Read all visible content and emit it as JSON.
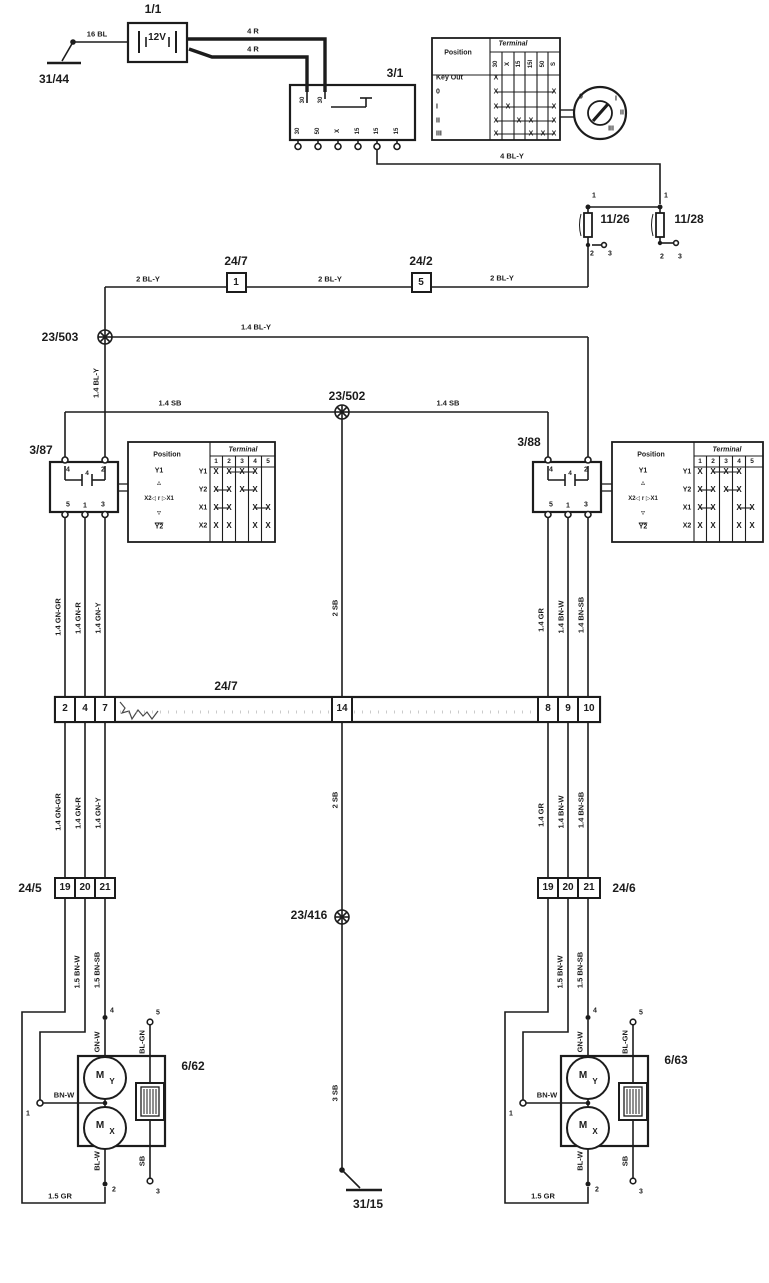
{
  "diagram": {
    "type": "wiring-diagram",
    "ink_color": "#1c1c1c",
    "bg_color": "#ffffff"
  },
  "ignition_table": {
    "position_header": "Position",
    "terminal_header": "Terminal",
    "columns": [
      "30",
      "X",
      "15",
      "15I",
      "50",
      "S"
    ],
    "rows": [
      {
        "label": "Key Out",
        "marks": [
          1,
          0,
          0,
          0,
          0,
          0
        ]
      },
      {
        "label": "0",
        "marks": [
          1,
          0,
          0,
          0,
          0,
          1
        ]
      },
      {
        "label": "I",
        "marks": [
          1,
          1,
          0,
          0,
          0,
          1
        ]
      },
      {
        "label": "II",
        "marks": [
          1,
          0,
          1,
          1,
          0,
          1
        ]
      },
      {
        "label": "III",
        "marks": [
          1,
          0,
          0,
          1,
          1,
          1
        ]
      }
    ]
  },
  "relay_table": {
    "position_header": "Position",
    "terminal_header": "Terminal",
    "columns": [
      "1",
      "2",
      "3",
      "4",
      "5"
    ],
    "rows": [
      {
        "label": "Y1",
        "marks": [
          1,
          1,
          1,
          1,
          0
        ]
      },
      {
        "label": "Y2",
        "marks": [
          1,
          1,
          1,
          1,
          0
        ]
      },
      {
        "label": "X1",
        "marks": [
          1,
          1,
          0,
          1,
          1
        ]
      },
      {
        "label": "X2",
        "marks": [
          1,
          1,
          0,
          1,
          1
        ]
      }
    ],
    "position_symbols": [
      "Y1",
      "▵",
      "X2◁ r ▷X1",
      "▿",
      "Y2"
    ]
  },
  "labels": [
    {
      "n": "ground-31-44-label",
      "t": "31/44",
      "x": 54,
      "y": 79,
      "fs": 12
    },
    {
      "n": "wire-label-16-bl",
      "t": "16 BL",
      "x": 97,
      "y": 34,
      "fs": 7.5
    },
    {
      "n": "battery-id",
      "t": "1/1",
      "x": 153,
      "y": 9,
      "fs": 12
    },
    {
      "n": "battery-voltage",
      "t": "12V",
      "x": 157,
      "y": 38,
      "fs": 10
    },
    {
      "n": "wire-label-4-r-upper",
      "t": "4 R",
      "x": 253,
      "y": 31,
      "fs": 7.5
    },
    {
      "n": "wire-label-4-r-lower",
      "t": "4 R",
      "x": 253,
      "y": 49,
      "fs": 7.5
    },
    {
      "n": "ignition-switch-id",
      "t": "3/1",
      "x": 395,
      "y": 73,
      "fs": 12
    },
    {
      "n": "ignition-pin-top-1",
      "t": "30",
      "x": 303,
      "y": 100,
      "fs": 6,
      "r": 1
    },
    {
      "n": "ignition-pin-top-2",
      "t": "30",
      "x": 321,
      "y": 100,
      "fs": 6,
      "r": 1
    },
    {
      "n": "ignition-pin-1",
      "t": "30",
      "x": 298,
      "y": 131,
      "fs": 6,
      "r": 1
    },
    {
      "n": "ignition-pin-2",
      "t": "50",
      "x": 318,
      "y": 131,
      "fs": 6,
      "r": 1
    },
    {
      "n": "ignition-pin-3",
      "t": "X",
      "x": 338,
      "y": 131,
      "fs": 6,
      "r": 1
    },
    {
      "n": "ignition-pin-4",
      "t": "15",
      "x": 358,
      "y": 131,
      "fs": 6,
      "r": 1
    },
    {
      "n": "ignition-pin-5",
      "t": "15",
      "x": 377,
      "y": 131,
      "fs": 6,
      "r": 1
    },
    {
      "n": "ignition-pin-6",
      "t": "15",
      "x": 397,
      "y": 131,
      "fs": 6,
      "r": 1
    },
    {
      "n": "key-position-0",
      "t": "0",
      "x": 581,
      "y": 97,
      "fs": 7
    },
    {
      "n": "key-position-i",
      "t": "I",
      "x": 616,
      "y": 99,
      "fs": 7
    },
    {
      "n": "key-position-ii",
      "t": "II",
      "x": 622,
      "y": 113,
      "fs": 7
    },
    {
      "n": "key-position-iii",
      "t": "III",
      "x": 611,
      "y": 129,
      "fs": 7
    },
    {
      "n": "wire-label-4-bl-y",
      "t": "4 BL-Y",
      "x": 512,
      "y": 156,
      "fs": 7.5
    },
    {
      "n": "fuse-11-26-pin-1",
      "t": "1",
      "x": 594,
      "y": 196,
      "fs": 7
    },
    {
      "n": "fuse-11-28-pin-1",
      "t": "1",
      "x": 666,
      "y": 196,
      "fs": 7
    },
    {
      "n": "fuse-11-26-id",
      "t": "11/26",
      "x": 615,
      "y": 219,
      "fs": 12
    },
    {
      "n": "fuse-11-28-id",
      "t": "11/28",
      "x": 689,
      "y": 219,
      "fs": 12
    },
    {
      "n": "fuse-11-26-pin-2",
      "t": "2",
      "x": 592,
      "y": 254,
      "fs": 7
    },
    {
      "n": "fuse-11-26-pin-3",
      "t": "3",
      "x": 610,
      "y": 254,
      "fs": 7
    },
    {
      "n": "fuse-11-28-pin-2",
      "t": "2",
      "x": 662,
      "y": 257,
      "fs": 7
    },
    {
      "n": "fuse-11-28-pin-3",
      "t": "3",
      "x": 680,
      "y": 257,
      "fs": 7
    },
    {
      "n": "wire-label-2-bl-y-a",
      "t": "2 BL-Y",
      "x": 148,
      "y": 279,
      "fs": 7.5
    },
    {
      "n": "connector-24-7-inline-id",
      "t": "24/7",
      "x": 236,
      "y": 261,
      "fs": 12
    },
    {
      "n": "connector-24-7-inline-pin",
      "t": "1",
      "x": 236,
      "y": 283,
      "fs": 10
    },
    {
      "n": "wire-label-2-bl-y-b",
      "t": "2 BL-Y",
      "x": 330,
      "y": 279,
      "fs": 7.5
    },
    {
      "n": "connector-24-2-id",
      "t": "24/2",
      "x": 421,
      "y": 261,
      "fs": 12
    },
    {
      "n": "connector-24-2-pin",
      "t": "5",
      "x": 421,
      "y": 283,
      "fs": 10
    },
    {
      "n": "wire-label-2-bl-y-c",
      "t": "2 BL-Y",
      "x": 502,
      "y": 278,
      "fs": 7.5
    },
    {
      "n": "splice-23-503-id",
      "t": "23/503",
      "x": 60,
      "y": 337,
      "fs": 12
    },
    {
      "n": "wire-label-1-4-bl-y-h",
      "t": "1.4 BL-Y",
      "x": 256,
      "y": 327,
      "fs": 7.5
    },
    {
      "n": "wire-label-1-4-bl-y-v",
      "t": "1.4 BL-Y",
      "x": 96,
      "y": 383,
      "fs": 7.5,
      "r": 1
    },
    {
      "n": "splice-23-502-id",
      "t": "23/502",
      "x": 347,
      "y": 396,
      "fs": 12
    },
    {
      "n": "wire-label-1-4-sb-a",
      "t": "1.4 SB",
      "x": 170,
      "y": 403,
      "fs": 7.5
    },
    {
      "n": "wire-label-1-4-sb-b",
      "t": "1.4 SB",
      "x": 448,
      "y": 403,
      "fs": 7.5
    },
    {
      "n": "relay-3-87-id",
      "t": "3/87",
      "x": 41,
      "y": 450,
      "fs": 12
    },
    {
      "n": "relay-3-88-id",
      "t": "3/88",
      "x": 529,
      "y": 442,
      "fs": 12
    },
    {
      "n": "relay-3-87-pin-4",
      "t": "4",
      "x": 68,
      "y": 470,
      "fs": 7
    },
    {
      "n": "relay-3-87-pin-2",
      "t": "2",
      "x": 103,
      "y": 470,
      "fs": 7
    },
    {
      "n": "relay-3-87-coil-4",
      "t": "4",
      "x": 87,
      "y": 474,
      "fs": 6.5
    },
    {
      "n": "relay-3-87-pin-5",
      "t": "5",
      "x": 68,
      "y": 505,
      "fs": 7
    },
    {
      "n": "relay-3-87-pin-1",
      "t": "1",
      "x": 85,
      "y": 506,
      "fs": 7
    },
    {
      "n": "relay-3-87-pin-3",
      "t": "3",
      "x": 103,
      "y": 505,
      "fs": 7
    },
    {
      "n": "relay-3-88-pin-4",
      "t": "4",
      "x": 551,
      "y": 470,
      "fs": 7
    },
    {
      "n": "relay-3-88-pin-2",
      "t": "2",
      "x": 586,
      "y": 470,
      "fs": 7
    },
    {
      "n": "relay-3-88-coil-4",
      "t": "4",
      "x": 570,
      "y": 474,
      "fs": 6.5
    },
    {
      "n": "relay-3-88-pin-5",
      "t": "5",
      "x": 551,
      "y": 505,
      "fs": 7
    },
    {
      "n": "relay-3-88-pin-1",
      "t": "1",
      "x": 568,
      "y": 506,
      "fs": 7
    },
    {
      "n": "relay-3-88-pin-3",
      "t": "3",
      "x": 586,
      "y": 505,
      "fs": 7
    },
    {
      "n": "wire-label-1-4-gn-gr-upper",
      "t": "1.4 GN-GR",
      "x": 58,
      "y": 617,
      "fs": 7.5,
      "r": 1
    },
    {
      "n": "wire-label-1-4-gn-r-upper",
      "t": "1.4 GN-R",
      "x": 78,
      "y": 618,
      "fs": 7.5,
      "r": 1
    },
    {
      "n": "wire-label-1-4-gn-y-upper",
      "t": "1.4 GN-Y",
      "x": 98,
      "y": 618,
      "fs": 7.5,
      "r": 1
    },
    {
      "n": "wire-label-2-sb-upper",
      "t": "2 SB",
      "x": 335,
      "y": 608,
      "fs": 7.5,
      "r": 1
    },
    {
      "n": "wire-label-1-4-gr-upper",
      "t": "1.4 GR",
      "x": 541,
      "y": 620,
      "fs": 7.5,
      "r": 1
    },
    {
      "n": "wire-label-1-4-bn-w-upper",
      "t": "1.4 BN-W",
      "x": 561,
      "y": 617,
      "fs": 7.5,
      "r": 1
    },
    {
      "n": "wire-label-1-4-bn-sb-upper",
      "t": "1.4 BN-SB",
      "x": 581,
      "y": 615,
      "fs": 7.5,
      "r": 1
    },
    {
      "n": "connector-24-7-id",
      "t": "24/7",
      "x": 226,
      "y": 686,
      "fs": 12
    },
    {
      "n": "connector-24-7-pin-2",
      "t": "2",
      "x": 65,
      "y": 709,
      "fs": 10
    },
    {
      "n": "connector-24-7-pin-4",
      "t": "4",
      "x": 85,
      "y": 709,
      "fs": 10
    },
    {
      "n": "connector-24-7-pin-7",
      "t": "7",
      "x": 105,
      "y": 709,
      "fs": 10
    },
    {
      "n": "connector-24-7-pin-14",
      "t": "14",
      "x": 342,
      "y": 709,
      "fs": 10
    },
    {
      "n": "connector-24-7-pin-8",
      "t": "8",
      "x": 548,
      "y": 709,
      "fs": 10
    },
    {
      "n": "connector-24-7-pin-9",
      "t": "9",
      "x": 568,
      "y": 709,
      "fs": 10
    },
    {
      "n": "connector-24-7-pin-10",
      "t": "10",
      "x": 589,
      "y": 709,
      "fs": 10
    },
    {
      "n": "wire-label-1-4-gn-gr-lower",
      "t": "1.4 GN-GR",
      "x": 58,
      "y": 812,
      "fs": 7.5,
      "r": 1
    },
    {
      "n": "wire-label-1-4-gn-r-lower",
      "t": "1.4 GN-R",
      "x": 78,
      "y": 813,
      "fs": 7.5,
      "r": 1
    },
    {
      "n": "wire-label-1-4-gn-y-lower",
      "t": "1.4 GN-Y",
      "x": 98,
      "y": 813,
      "fs": 7.5,
      "r": 1
    },
    {
      "n": "wire-label-2-sb-lower",
      "t": "2 SB",
      "x": 335,
      "y": 800,
      "fs": 7.5,
      "r": 1
    },
    {
      "n": "wire-label-1-4-gr-lower",
      "t": "1.4 GR",
      "x": 541,
      "y": 815,
      "fs": 7.5,
      "r": 1
    },
    {
      "n": "wire-label-1-4-bn-w-lower",
      "t": "1.4 BN-W",
      "x": 561,
      "y": 812,
      "fs": 7.5,
      "r": 1
    },
    {
      "n": "wire-label-1-4-bn-sb-lower",
      "t": "1.4 BN-SB",
      "x": 581,
      "y": 810,
      "fs": 7.5,
      "r": 1
    },
    {
      "n": "connector-24-5-id",
      "t": "24/5",
      "x": 30,
      "y": 888,
      "fs": 12
    },
    {
      "n": "connector-24-5-pin-19",
      "t": "19",
      "x": 65,
      "y": 888,
      "fs": 10
    },
    {
      "n": "connector-24-5-pin-20",
      "t": "20",
      "x": 85,
      "y": 888,
      "fs": 10
    },
    {
      "n": "connector-24-5-pin-21",
      "t": "21",
      "x": 105,
      "y": 888,
      "fs": 10
    },
    {
      "n": "connector-24-6-pin-19",
      "t": "19",
      "x": 548,
      "y": 888,
      "fs": 10
    },
    {
      "n": "connector-24-6-pin-20",
      "t": "20",
      "x": 568,
      "y": 888,
      "fs": 10
    },
    {
      "n": "connector-24-6-pin-21",
      "t": "21",
      "x": 589,
      "y": 888,
      "fs": 10
    },
    {
      "n": "connector-24-6-id",
      "t": "24/6",
      "x": 624,
      "y": 888,
      "fs": 12
    },
    {
      "n": "splice-23-416-id",
      "t": "23/416",
      "x": 309,
      "y": 915,
      "fs": 12
    },
    {
      "n": "wire-label-1-5-bn-w-left",
      "t": "1.5 BN-W",
      "x": 77,
      "y": 972,
      "fs": 7.5,
      "r": 1
    },
    {
      "n": "wire-label-1-5-bn-sb-left",
      "t": "1.5 BN-SB",
      "x": 97,
      "y": 970,
      "fs": 7.5,
      "r": 1
    },
    {
      "n": "wire-label-1-5-bn-w-right",
      "t": "1.5 BN-W",
      "x": 560,
      "y": 972,
      "fs": 7.5,
      "r": 1
    },
    {
      "n": "wire-label-1-5-bn-sb-right",
      "t": "1.5 BN-SB",
      "x": 580,
      "y": 970,
      "fs": 7.5,
      "r": 1
    },
    {
      "n": "mirror-left-pin-4",
      "t": "4",
      "x": 112,
      "y": 1011,
      "fs": 7
    },
    {
      "n": "mirror-left-pin-5",
      "t": "5",
      "x": 158,
      "y": 1013,
      "fs": 7
    },
    {
      "n": "wire-label-gn-w-left",
      "t": "GN-W",
      "x": 97,
      "y": 1042,
      "fs": 7.5,
      "r": 1
    },
    {
      "n": "wire-label-bl-gn-left",
      "t": "BL-GN",
      "x": 142,
      "y": 1042,
      "fs": 7.5,
      "r": 1
    },
    {
      "n": "mirror-left-id",
      "t": "6/62",
      "x": 193,
      "y": 1066,
      "fs": 12
    },
    {
      "n": "mirror-left-pin-1",
      "t": "1",
      "x": 28,
      "y": 1114,
      "fs": 7
    },
    {
      "n": "wire-label-bn-w-left",
      "t": "BN-W",
      "x": 64,
      "y": 1095,
      "fs": 7.5
    },
    {
      "n": "motor-left-y-m",
      "t": "M",
      "x": 100,
      "y": 1076,
      "fs": 10
    },
    {
      "n": "motor-left-y-sub",
      "t": "Y",
      "x": 112,
      "y": 1082,
      "fs": 8
    },
    {
      "n": "motor-left-x-m",
      "t": "M",
      "x": 100,
      "y": 1126,
      "fs": 10
    },
    {
      "n": "motor-left-x-sub",
      "t": "X",
      "x": 112,
      "y": 1132,
      "fs": 8
    },
    {
      "n": "wire-label-bl-w-left",
      "t": "BL-W",
      "x": 97,
      "y": 1161,
      "fs": 7.5,
      "r": 1
    },
    {
      "n": "wire-label-sb-left",
      "t": "SB",
      "x": 142,
      "y": 1161,
      "fs": 7.5,
      "r": 1
    },
    {
      "n": "mirror-left-pin-2",
      "t": "2",
      "x": 114,
      "y": 1190,
      "fs": 7
    },
    {
      "n": "mirror-left-pin-3",
      "t": "3",
      "x": 158,
      "y": 1192,
      "fs": 7
    },
    {
      "n": "wire-label-1-5-gr-left",
      "t": "1.5 GR",
      "x": 60,
      "y": 1196,
      "fs": 7.5
    },
    {
      "n": "mirror-right-pin-4",
      "t": "4",
      "x": 595,
      "y": 1011,
      "fs": 7
    },
    {
      "n": "mirror-right-pin-5",
      "t": "5",
      "x": 641,
      "y": 1013,
      "fs": 7
    },
    {
      "n": "wire-label-gn-w-right",
      "t": "GN-W",
      "x": 580,
      "y": 1042,
      "fs": 7.5,
      "r": 1
    },
    {
      "n": "wire-label-bl-gn-right",
      "t": "BL-GN",
      "x": 625,
      "y": 1042,
      "fs": 7.5,
      "r": 1
    },
    {
      "n": "mirror-right-id",
      "t": "6/63",
      "x": 676,
      "y": 1060,
      "fs": 12
    },
    {
      "n": "mirror-right-pin-1",
      "t": "1",
      "x": 511,
      "y": 1114,
      "fs": 7
    },
    {
      "n": "wire-label-bn-w-right",
      "t": "BN-W",
      "x": 547,
      "y": 1095,
      "fs": 7.5
    },
    {
      "n": "motor-right-y-m",
      "t": "M",
      "x": 583,
      "y": 1076,
      "fs": 10
    },
    {
      "n": "motor-right-y-sub",
      "t": "Y",
      "x": 595,
      "y": 1082,
      "fs": 8
    },
    {
      "n": "motor-right-x-m",
      "t": "M",
      "x": 583,
      "y": 1126,
      "fs": 10
    },
    {
      "n": "motor-right-x-sub",
      "t": "X",
      "x": 595,
      "y": 1132,
      "fs": 8
    },
    {
      "n": "wire-label-bl-w-right",
      "t": "BL-W",
      "x": 580,
      "y": 1161,
      "fs": 7.5,
      "r": 1
    },
    {
      "n": "wire-label-sb-right",
      "t": "SB",
      "x": 625,
      "y": 1161,
      "fs": 7.5,
      "r": 1
    },
    {
      "n": "mirror-right-pin-2",
      "t": "2",
      "x": 597,
      "y": 1190,
      "fs": 7
    },
    {
      "n": "mirror-right-pin-3",
      "t": "3",
      "x": 641,
      "y": 1192,
      "fs": 7
    },
    {
      "n": "wire-label-1-5-gr-right",
      "t": "1.5 GR",
      "x": 543,
      "y": 1196,
      "fs": 7.5
    },
    {
      "n": "wire-label-3-sb",
      "t": "3 SB",
      "x": 335,
      "y": 1093,
      "fs": 7.5,
      "r": 1
    },
    {
      "n": "ground-31-15-label",
      "t": "31/15",
      "x": 368,
      "y": 1204,
      "fs": 12
    }
  ]
}
